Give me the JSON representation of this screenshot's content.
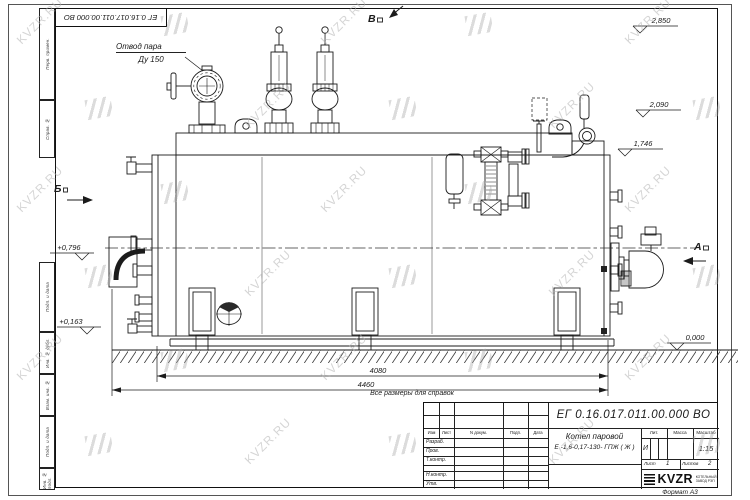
{
  "watermark": {
    "text": "KVZR.RU"
  },
  "colors": {
    "line": "#1b1b1b",
    "watermark": "#b3b3b3"
  },
  "sheet": {
    "top_stamp": "ЕГ 0.16.017.011.00.000 ВО",
    "format_note": "Формат А3",
    "reference_note": "Все размеры для справок",
    "side_columns": [
      {
        "label": "Перв. примен."
      },
      {
        "label": "Справ. №"
      },
      {
        "label": "Подп. и дата"
      },
      {
        "label": "Инв. № дубл."
      },
      {
        "label": "Взам. инв. №"
      },
      {
        "label": "Подп. и дата"
      },
      {
        "label": "Инв. № подл."
      }
    ]
  },
  "drawing": {
    "steam_label_line1": "Отвод пара",
    "steam_label_line2": "Ду 150",
    "views": {
      "top": "В",
      "left": "Б",
      "right": "А"
    },
    "elevations": {
      "v1": "2,850",
      "v2": "2,090",
      "v3": "1,746",
      "v4": "+0,796",
      "v5": "+0,163",
      "v6": "0,000"
    },
    "dimensions": {
      "length_body": "4080",
      "length_total": "4460"
    }
  },
  "title_block": {
    "designation": "ЕГ 0.16.017.011.00.000 ВО",
    "name_line1": "Котел паровой",
    "name_line2": "Е -1,6-0,17-130- ГПЖ ( Ж )",
    "header_cols": [
      "Изм",
      "Лист",
      "N докум.",
      "Подп.",
      "Дата"
    ],
    "sig_rows": [
      "Разраб.",
      "Пров.",
      "Т.контр.",
      "Н.контр.",
      "Утв."
    ],
    "lit_label": "Лит.",
    "mass_label": "Масса",
    "scale_label": "Масштаб",
    "lit_value": "И",
    "scale_value": "1:15",
    "sheet_label": "Лист",
    "sheet_value": "1",
    "sheets_label": "Листов",
    "sheets_value": "2",
    "logo_text": "KVZR",
    "logo_sub1": "КОТЕЛЬНЫЙ",
    "logo_sub2": "ЗАВОД РЭП"
  }
}
